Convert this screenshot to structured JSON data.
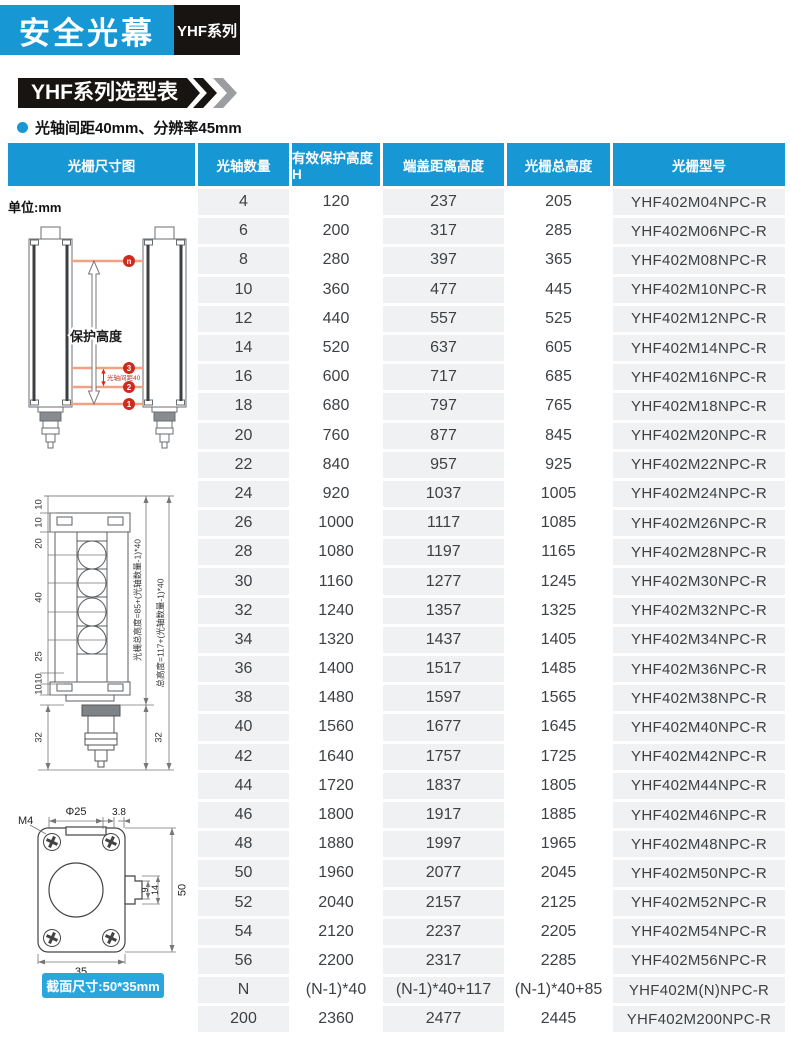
{
  "header": {
    "title": "安全光幕",
    "series_badge": "YHF系列"
  },
  "section": {
    "banner": "YHF系列选型表",
    "bullet": "光轴间距40mm、分辨率45mm"
  },
  "colors": {
    "accent_blue": "#1798d5",
    "banner_black": "#181411",
    "row_gray": "#eff1f2",
    "beam_orange": "#f2a183",
    "marker_red": "#ce2b1f",
    "caption_blue": "#2aa6de"
  },
  "table": {
    "unit_label": "单位:mm",
    "columns": [
      "光栅尺寸图",
      "光轴数量",
      "有效保护高度H",
      "端盖距离高度",
      "光栅总高度",
      "光栅型号"
    ],
    "rows": [
      [
        "4",
        "120",
        "237",
        "205",
        "YHF402M04NPC-R"
      ],
      [
        "6",
        "200",
        "317",
        "285",
        "YHF402M06NPC-R"
      ],
      [
        "8",
        "280",
        "397",
        "365",
        "YHF402M08NPC-R"
      ],
      [
        "10",
        "360",
        "477",
        "445",
        "YHF402M10NPC-R"
      ],
      [
        "12",
        "440",
        "557",
        "525",
        "YHF402M12NPC-R"
      ],
      [
        "14",
        "520",
        "637",
        "605",
        "YHF402M14NPC-R"
      ],
      [
        "16",
        "600",
        "717",
        "685",
        "YHF402M16NPC-R"
      ],
      [
        "18",
        "680",
        "797",
        "765",
        "YHF402M18NPC-R"
      ],
      [
        "20",
        "760",
        "877",
        "845",
        "YHF402M20NPC-R"
      ],
      [
        "22",
        "840",
        "957",
        "925",
        "YHF402M22NPC-R"
      ],
      [
        "24",
        "920",
        "1037",
        "1005",
        "YHF402M24NPC-R"
      ],
      [
        "26",
        "1000",
        "1117",
        "1085",
        "YHF402M26NPC-R"
      ],
      [
        "28",
        "1080",
        "1197",
        "1165",
        "YHF402M28NPC-R"
      ],
      [
        "30",
        "1160",
        "1277",
        "1245",
        "YHF402M30NPC-R"
      ],
      [
        "32",
        "1240",
        "1357",
        "1325",
        "YHF402M32NPC-R"
      ],
      [
        "34",
        "1320",
        "1437",
        "1405",
        "YHF402M34NPC-R"
      ],
      [
        "36",
        "1400",
        "1517",
        "1485",
        "YHF402M36NPC-R"
      ],
      [
        "38",
        "1480",
        "1597",
        "1565",
        "YHF402M38NPC-R"
      ],
      [
        "40",
        "1560",
        "1677",
        "1645",
        "YHF402M40NPC-R"
      ],
      [
        "42",
        "1640",
        "1757",
        "1725",
        "YHF402M42NPC-R"
      ],
      [
        "44",
        "1720",
        "1837",
        "1805",
        "YHF402M44NPC-R"
      ],
      [
        "46",
        "1800",
        "1917",
        "1885",
        "YHF402M46NPC-R"
      ],
      [
        "48",
        "1880",
        "1997",
        "1965",
        "YHF402M48NPC-R"
      ],
      [
        "50",
        "1960",
        "2077",
        "2045",
        "YHF402M50NPC-R"
      ],
      [
        "52",
        "2040",
        "2157",
        "2125",
        "YHF402M52NPC-R"
      ],
      [
        "54",
        "2120",
        "2237",
        "2205",
        "YHF402M54NPC-R"
      ],
      [
        "56",
        "2200",
        "2317",
        "2285",
        "YHF402M56NPC-R"
      ],
      [
        "N",
        "(N-1)*40",
        "(N-1)*40+117",
        "(N-1)*40+85",
        "YHF402M(N)NPC-R"
      ],
      [
        "200",
        "2360",
        "2477",
        "2445",
        "YHF402M200NPC-R"
      ]
    ]
  },
  "diagrams": {
    "protection": {
      "height_label": "保护高度",
      "pitch_label": "光轴间距40",
      "markers": [
        "n",
        "3",
        "2",
        "1"
      ]
    },
    "front_view": {
      "dims": [
        "10",
        "10",
        "20",
        "40",
        "25",
        "10",
        "10",
        "32"
      ],
      "connector_dim": "32",
      "grating_total_label": "光栅总高度=85+(光轴数量-1)*40",
      "total_height_label": "总高度=117+(光轴数量-1)*40"
    },
    "cross_section": {
      "m4": "M4",
      "phi": "Φ25",
      "slot": "3.8",
      "notch_inner": "9",
      "notch_outer": "14",
      "height": "50",
      "width": "35",
      "caption": "截面尺寸:50*35mm"
    }
  }
}
